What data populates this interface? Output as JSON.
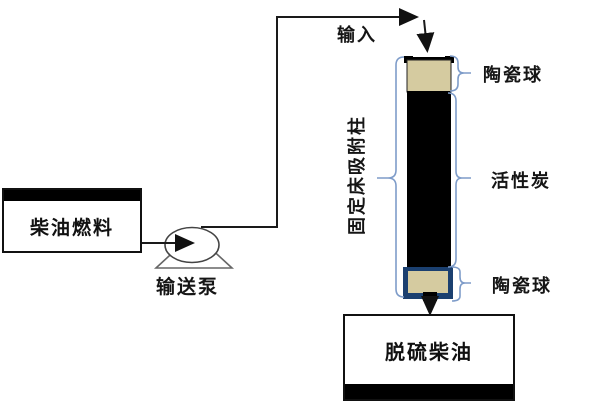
{
  "diagram": {
    "labels": {
      "input": "输入",
      "ceramic_top": "陶瓷球",
      "activated_carbon": "活性炭",
      "ceramic_bottom": "陶瓷球",
      "column": "固定床吸附柱",
      "diesel_fuel": "柴油燃料",
      "pump": "输送泵",
      "desulfurized_diesel": "脱硫柴油"
    },
    "colors": {
      "ceramic_fill": "#d5cba0",
      "carbon_fill": "#000000",
      "column_base": "#1b4070",
      "bracket": "#7e9cc9",
      "line": "#1a1a1a"
    }
  }
}
